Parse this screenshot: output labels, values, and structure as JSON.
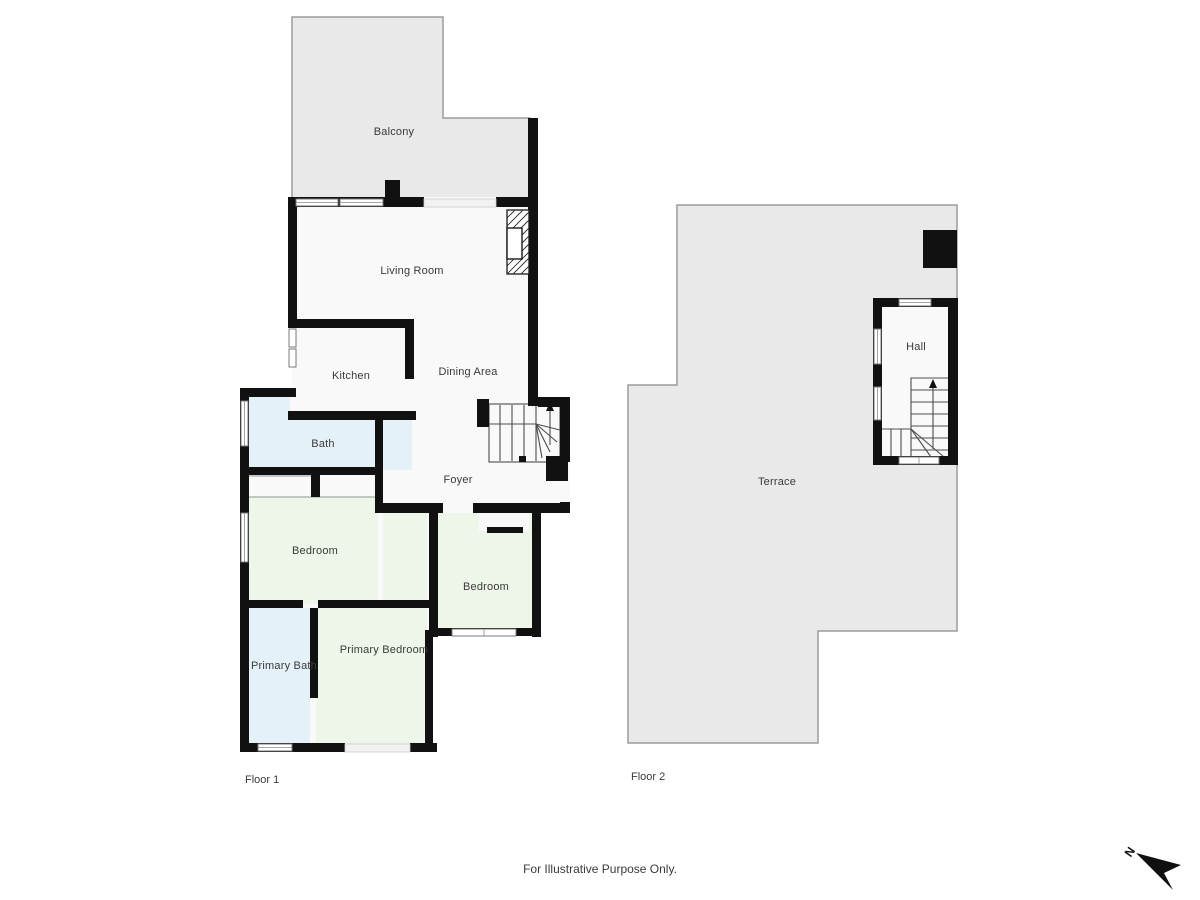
{
  "caption": "For Illustrative Purpose Only.",
  "compass": {
    "label": "N"
  },
  "floors": [
    {
      "id": "floor1",
      "label": "Floor 1",
      "label_pos": {
        "x": 245,
        "y": 780
      },
      "rooms": [
        {
          "name": "balcony",
          "label": "Balcony",
          "x": 394,
          "y": 132
        },
        {
          "name": "living-room",
          "label": "Living Room",
          "x": 412,
          "y": 271
        },
        {
          "name": "kitchen",
          "label": "Kitchen",
          "x": 351,
          "y": 376
        },
        {
          "name": "dining-area",
          "label": "Dining Area",
          "x": 468,
          "y": 372
        },
        {
          "name": "bath",
          "label": "Bath",
          "x": 323,
          "y": 444
        },
        {
          "name": "foyer",
          "label": "Foyer",
          "x": 458,
          "y": 480
        },
        {
          "name": "bedroom",
          "label": "Bedroom",
          "x": 315,
          "y": 551
        },
        {
          "name": "bedroom-2",
          "label": "Bedroom",
          "x": 486,
          "y": 587
        },
        {
          "name": "primary-bath",
          "label": "Primary Bath",
          "x": 284,
          "y": 666
        },
        {
          "name": "primary-bedroom",
          "label": "Primary Bedroom",
          "x": 384,
          "y": 650
        }
      ]
    },
    {
      "id": "floor2",
      "label": "Floor 2",
      "label_pos": {
        "x": 631,
        "y": 777
      },
      "rooms": [
        {
          "name": "hall",
          "label": "Hall",
          "x": 916,
          "y": 347
        },
        {
          "name": "terrace",
          "label": "Terrace",
          "x": 777,
          "y": 482
        }
      ]
    }
  ],
  "colors": {
    "wall": "#111111",
    "outdoor_fill": "#e9e9e9",
    "outdoor_stroke": "#9c9c9c",
    "room_fill": "#f9f9f9",
    "bath_fill": "#e5f1f8",
    "bedroom_fill": "#eef5e9",
    "label_text": "#3a3a3a"
  }
}
